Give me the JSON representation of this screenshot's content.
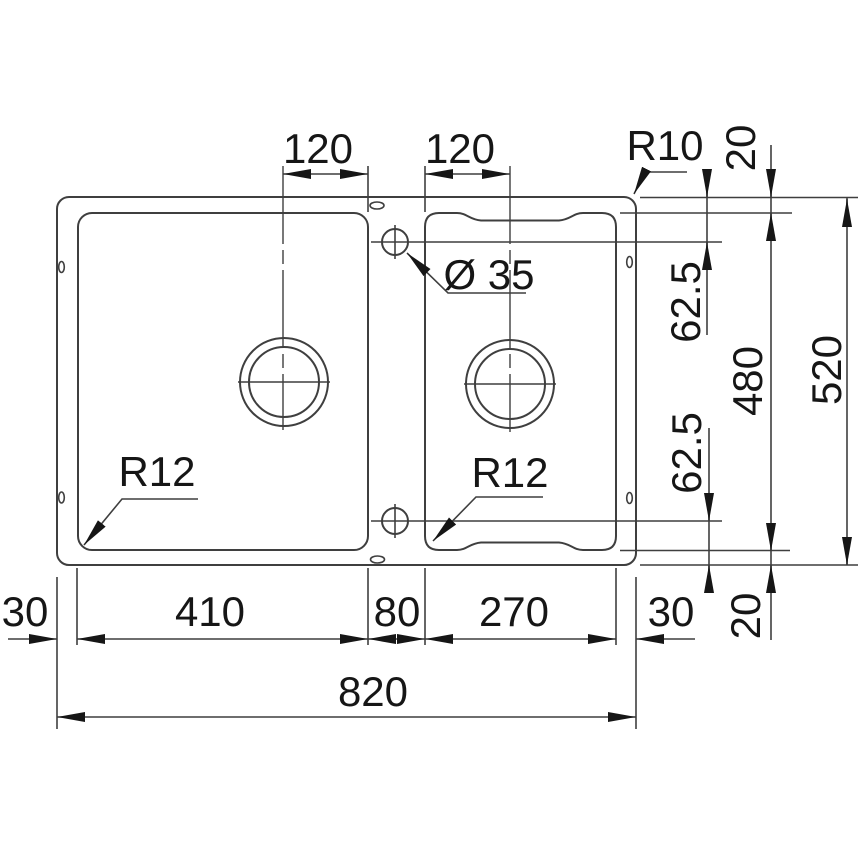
{
  "colors": {
    "line": "#3f3f3f",
    "ink": "#161616",
    "bg": "#ffffff"
  },
  "top": {
    "left_drain_offset": "120",
    "right_drain_offset": "120",
    "corner_radius": "R10",
    "rim_top": "20"
  },
  "right": {
    "hole_top_offset": "62.5",
    "inner_height": "480",
    "overall_height": "520",
    "hole_bottom_offset": "62.5",
    "rim_bottom": "20"
  },
  "annotations": {
    "tap_hole_diameter": "Ø 35",
    "left_bowl_radius": "R12",
    "right_bowl_radius": "R12"
  },
  "bottom": {
    "margin_left": "30",
    "left_bowl_width": "410",
    "gap_width": "80",
    "right_bowl_width": "270",
    "margin_right": "30",
    "overall_width": "820"
  }
}
